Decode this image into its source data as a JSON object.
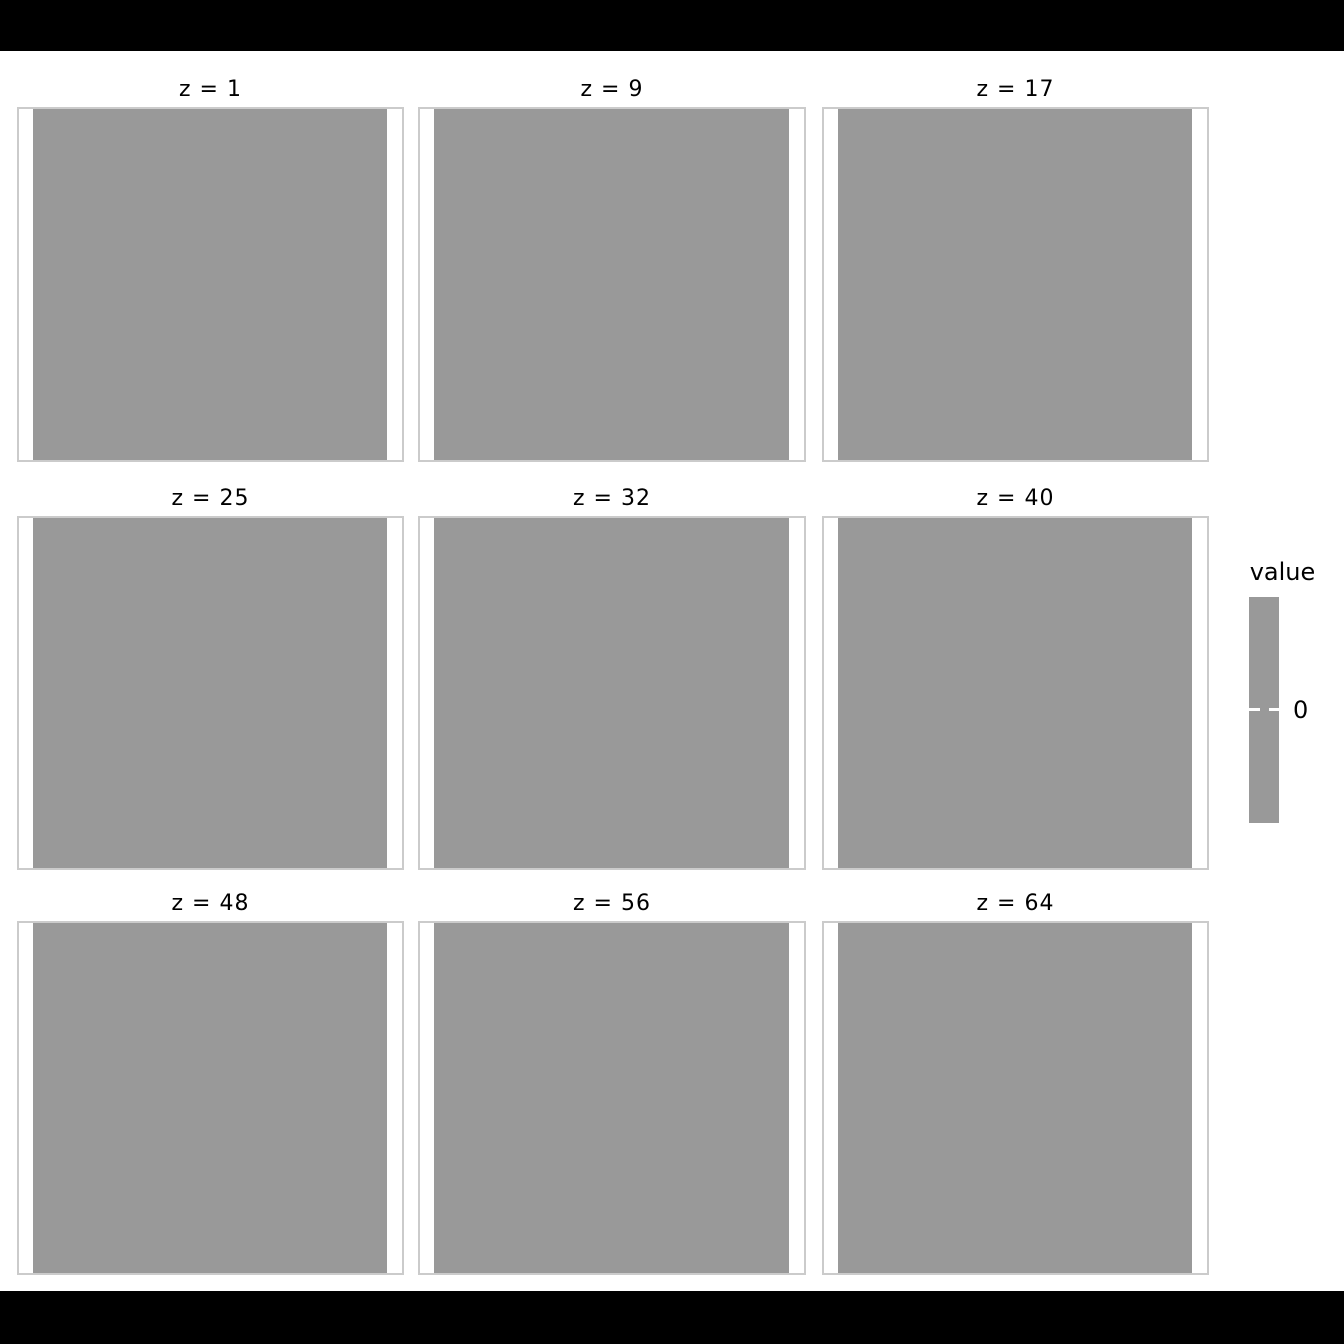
{
  "colors": {
    "background": "#ffffff",
    "letterbox": "#000000",
    "raster_gray": "#999999",
    "panel_border": "#cbcbcb",
    "text": "#000000",
    "colorbar_tick": "#ffffff"
  },
  "chart_data": {
    "type": "heatmap",
    "title": "",
    "facet_grid": {
      "rows": 3,
      "cols": 3,
      "variable": "z"
    },
    "facets": [
      {
        "label": "z = 1",
        "z": 1,
        "uniform_value": 0
      },
      {
        "label": "z = 9",
        "z": 9,
        "uniform_value": 0
      },
      {
        "label": "z = 17",
        "z": 17,
        "uniform_value": 0
      },
      {
        "label": "z = 25",
        "z": 25,
        "uniform_value": 0
      },
      {
        "label": "z = 32",
        "z": 32,
        "uniform_value": 0
      },
      {
        "label": "z = 40",
        "z": 40,
        "uniform_value": 0
      },
      {
        "label": "z = 48",
        "z": 48,
        "uniform_value": 0
      },
      {
        "label": "z = 56",
        "z": 56,
        "uniform_value": 0
      },
      {
        "label": "z = 64",
        "z": 64,
        "uniform_value": 0
      }
    ],
    "cell_color": "#999999",
    "legend": {
      "title": "value",
      "ticks": [
        "0"
      ],
      "position": "right"
    },
    "grid": "off",
    "axes": "none"
  }
}
